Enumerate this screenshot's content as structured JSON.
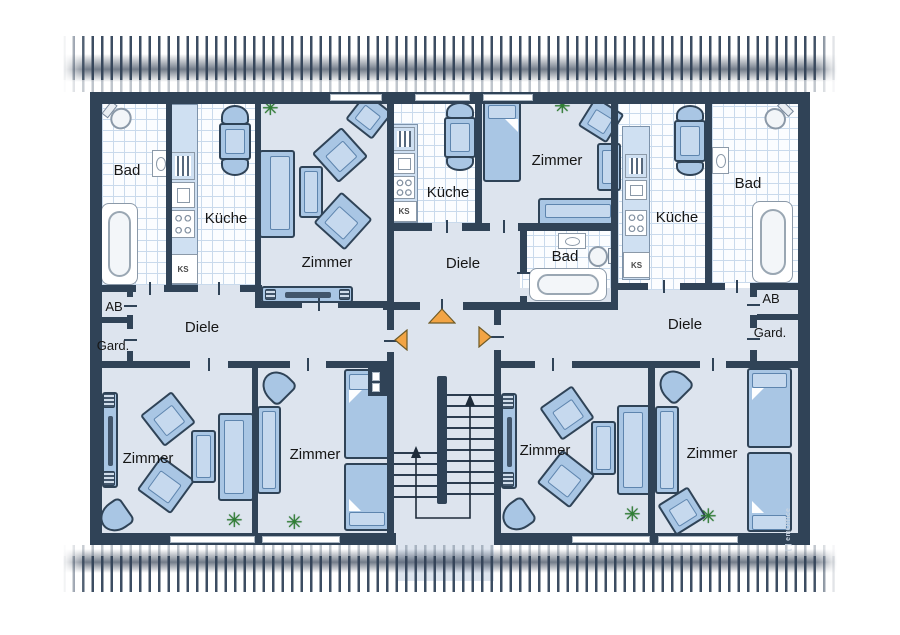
{
  "labels": {
    "bad_left": "Bad",
    "kueche_left": "Küche",
    "zimmer_top_left": "Zimmer",
    "diele_left": "Diele",
    "ab_left": "AB",
    "gard_left": "Gard.",
    "ks": "KS",
    "kueche_mid": "Küche",
    "zimmer_mid": "Zimmer",
    "diele_mid": "Diele",
    "bad_mid": "Bad",
    "kueche_right": "Küche",
    "bad_right": "Bad",
    "diele_right": "Diele",
    "ab_right": "AB",
    "gard_right": "Gard.",
    "zimmer_bottom_left": "Zimmer",
    "zimmer_bottom_left2": "Zimmer",
    "zimmer_bottom_right2": "Zimmer",
    "zimmer_bottom_right": "Zimmer"
  },
  "icons": {
    "plant": "✳"
  },
  "watermark": {
    "text": "[ ] emOffice"
  },
  "colors": {
    "wall": "#304357",
    "floor": "#dde4ee",
    "tile_bg": "#fbfdff",
    "tile_line": "#c9daec",
    "furniture": "#a9c6e4",
    "furniture_light": "#c6d9ee",
    "entrance_arrow": "#f2a444",
    "plant": "#2e7f33",
    "roof_stripe": "#3c4d62"
  }
}
